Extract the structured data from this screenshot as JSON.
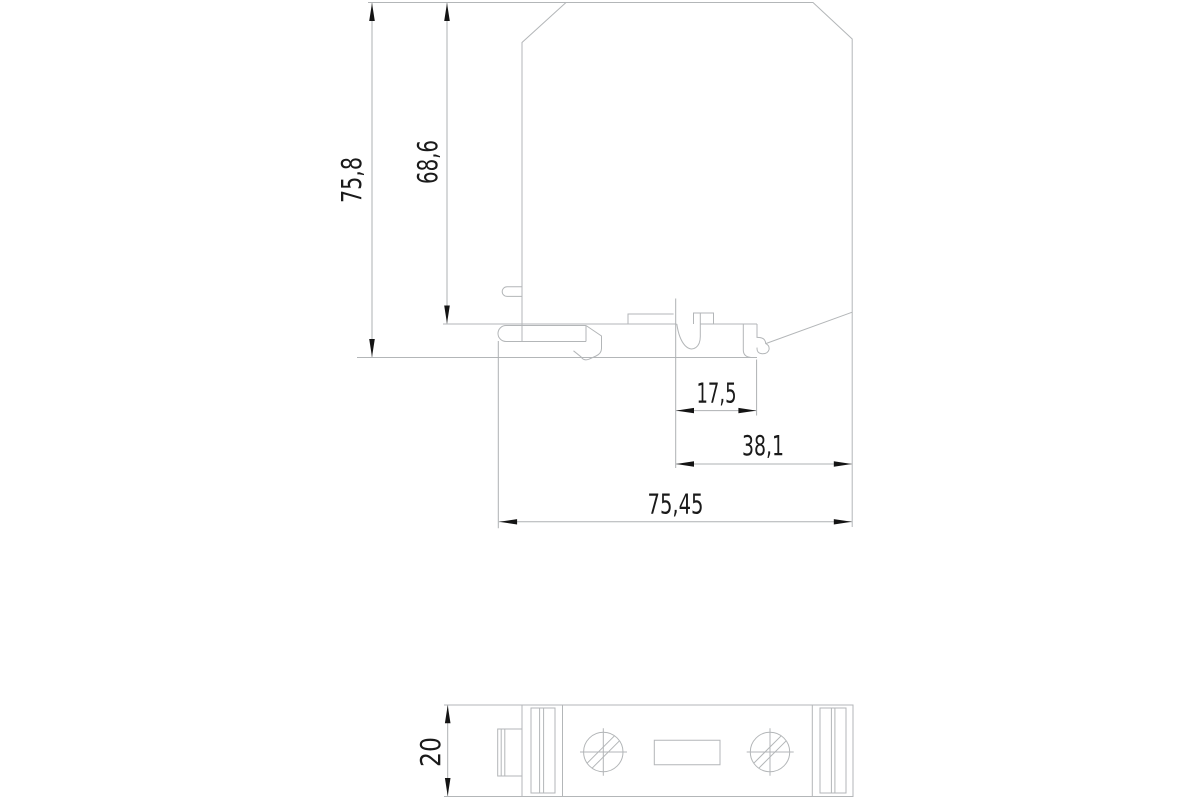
{
  "colors": {
    "background": "#ffffff",
    "geometry_line": "#b3b6b8",
    "dimension_line": "#aeb1b3",
    "arrow": "#141414",
    "text": "#1a1a1a"
  },
  "side_view": {
    "dimensions": {
      "overall_height": "75,8",
      "body_height": "68,6",
      "notch_width": "17,5",
      "notch_to_edge": "38,1",
      "overall_width": "75,45"
    }
  },
  "bottom_view": {
    "dimensions": {
      "depth": "20"
    }
  }
}
